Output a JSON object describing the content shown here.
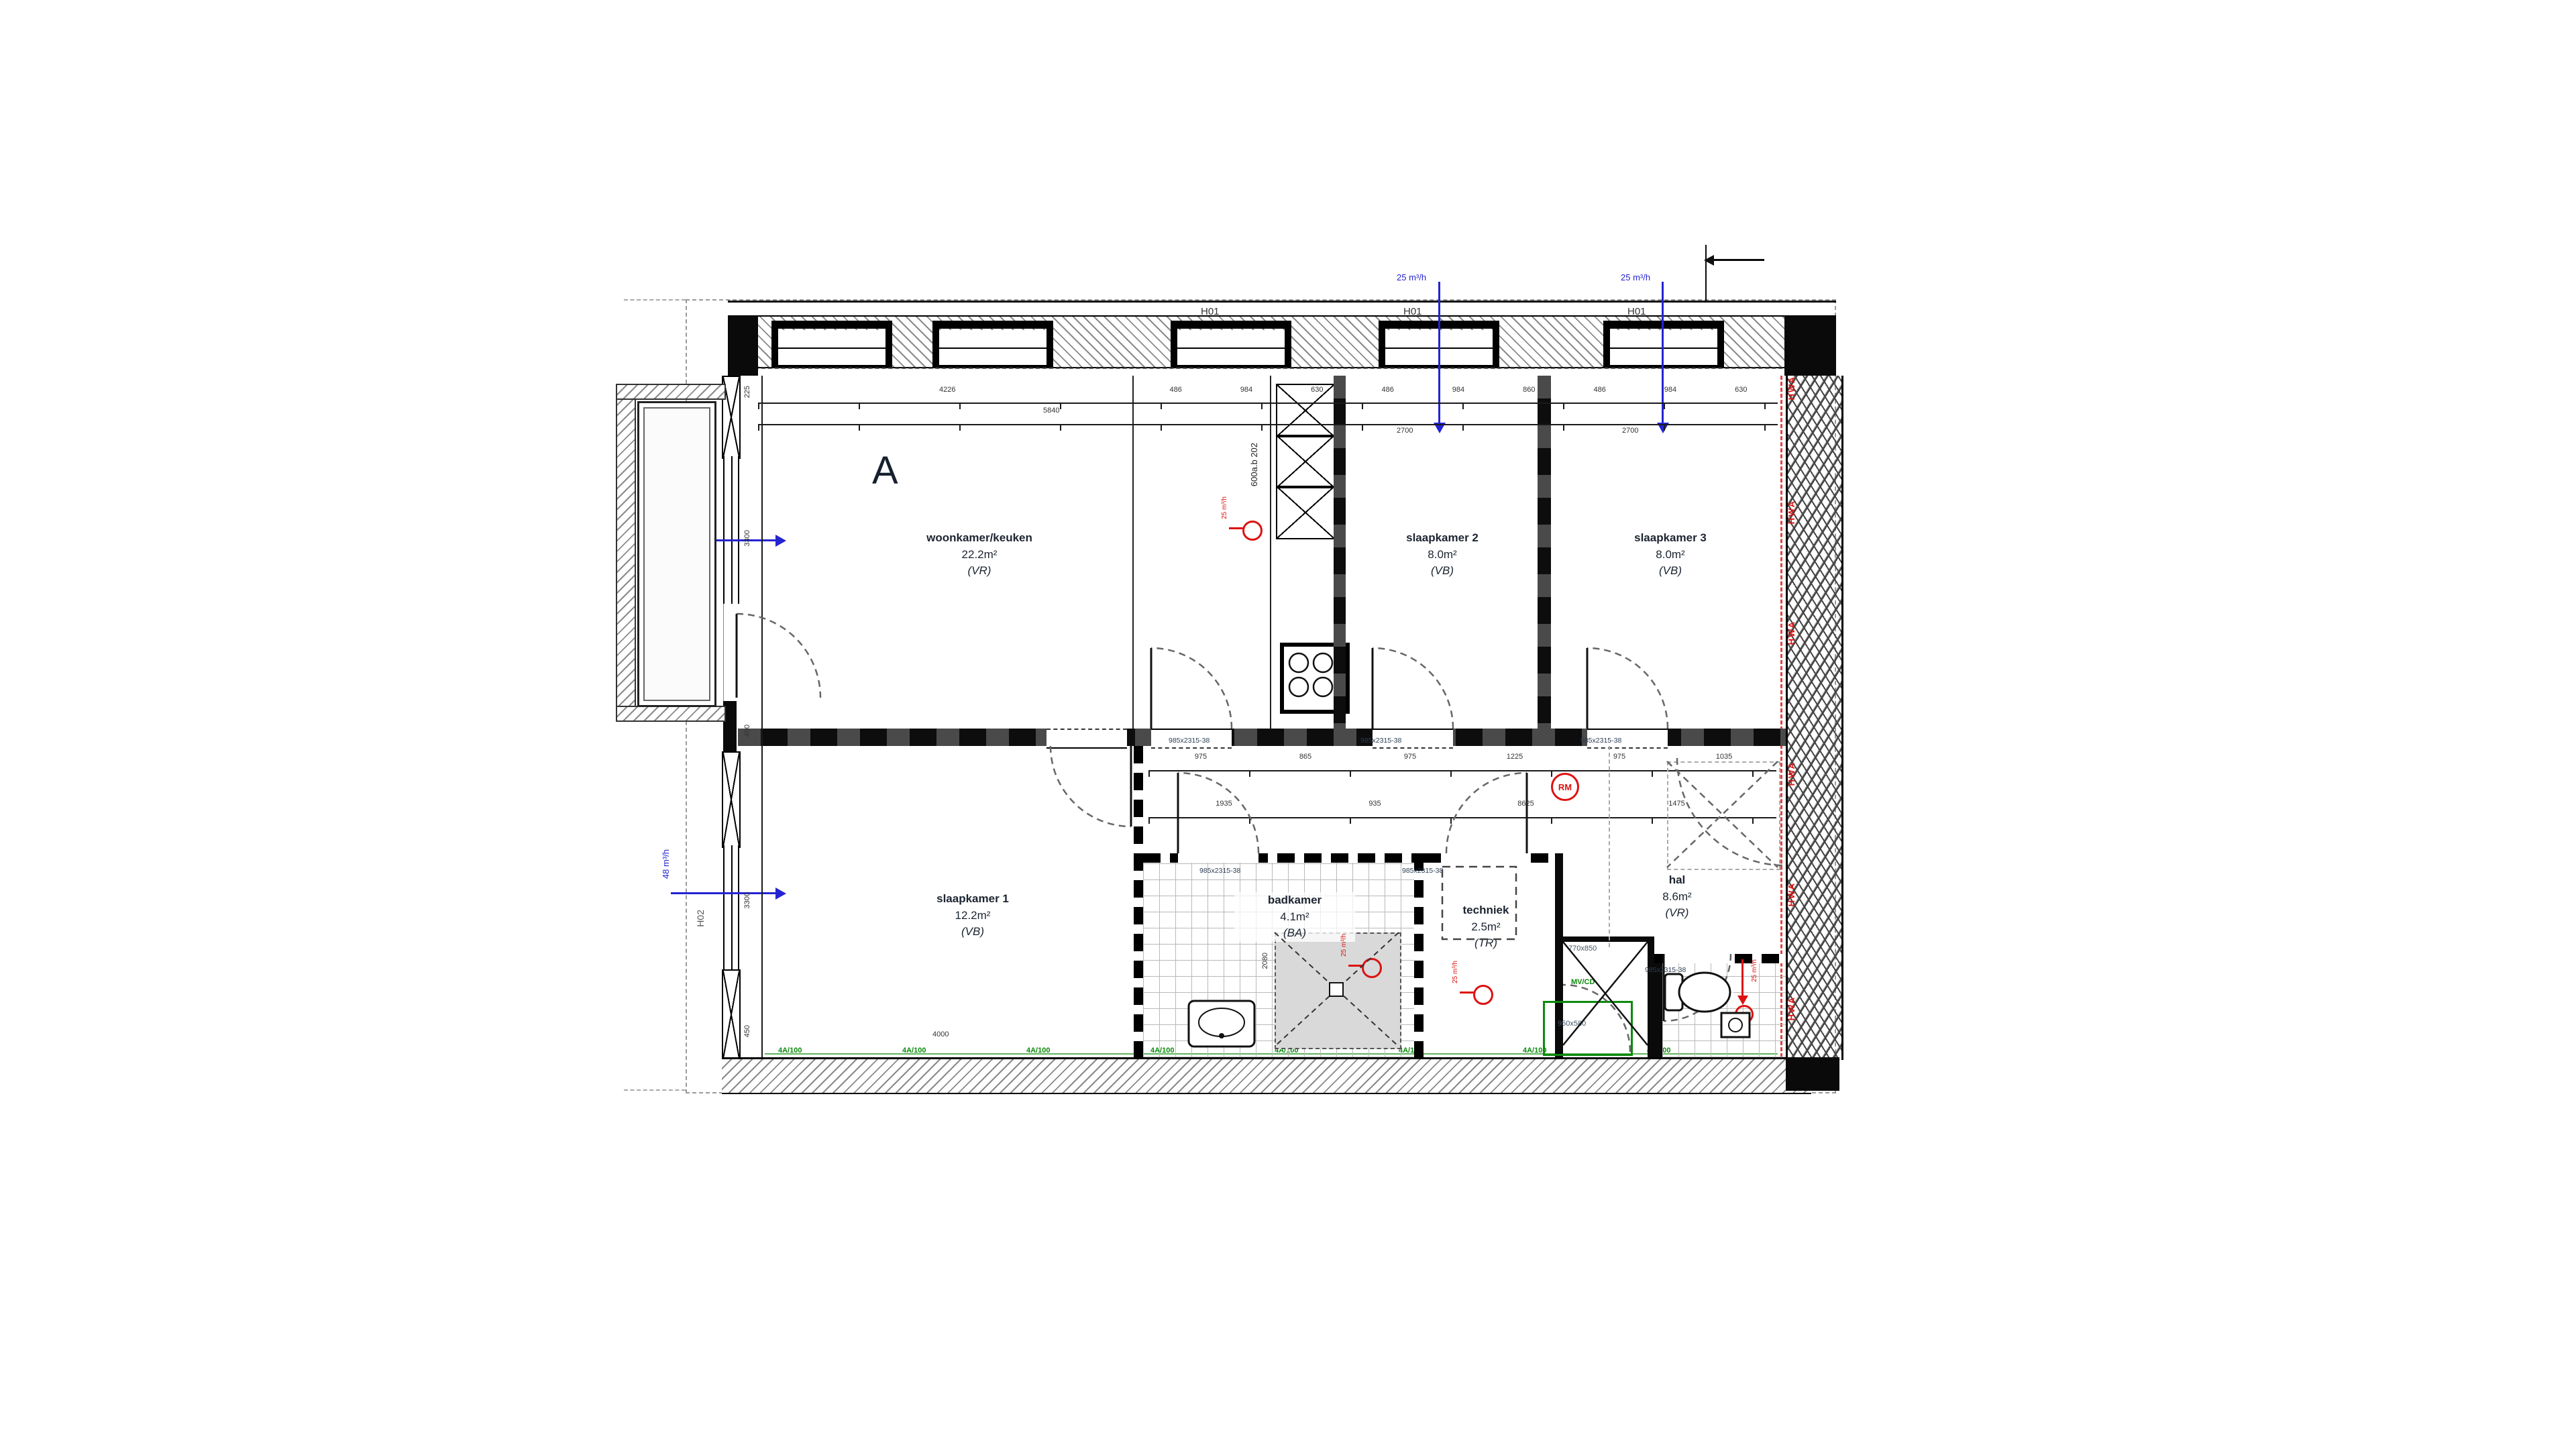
{
  "unit_label": "A",
  "rooms": [
    {
      "name": "woonkamer/keuken",
      "area": "22.2m²",
      "type": "(VR)"
    },
    {
      "name": "slaapkamer 2",
      "area": "8.0m²",
      "type": "(VB)"
    },
    {
      "name": "slaapkamer 3",
      "area": "8.0m²",
      "type": "(VB)"
    },
    {
      "name": "slaapkamer 1",
      "area": "12.2m²",
      "type": "(VB)"
    },
    {
      "name": "badkamer",
      "area": "4.1m²",
      "type": "(BA)"
    },
    {
      "name": "techniek",
      "area": "2.5m²",
      "type": "(TR)"
    },
    {
      "name": "hal",
      "area": "8.6m²",
      "type": "(VR)"
    },
    {
      "name": "toilet",
      "area": "",
      "type": ""
    }
  ],
  "window_labels": {
    "top": [
      "H01",
      "H01",
      "H01"
    ],
    "left_upper": "H10",
    "left_lower": "H02"
  },
  "ventilation": {
    "top_flows": [
      "25 m³/h",
      "25 m³/h"
    ],
    "left_upper_flow": "83 m³/h",
    "left_lower_flow": "48 m³/h",
    "extract_flow": "25 m³/h"
  },
  "markers": {
    "smoke_detector": "RM",
    "riser_label": "HWA",
    "koker_note": "600a.b 202",
    "shaft_size_top": "770x850",
    "shaft_size_bottom": "950x580",
    "meter_label": "MV/CD",
    "door_tag": "985x2315-38",
    "green_mark": "4A/100"
  },
  "dimensions": {
    "top_main": [
      "4226",
      "5840"
    ],
    "top_segments": [
      "486",
      "984",
      "630",
      "486",
      "984",
      "860",
      "486",
      "984",
      "630"
    ],
    "top_totals": [
      "2700",
      "2700"
    ],
    "left_column": [
      "225",
      "3300",
      "450",
      "3300",
      "450"
    ],
    "hall_upper": [
      "975",
      "865",
      "975",
      "1225",
      "975",
      "1035"
    ],
    "hall_lower": [
      "1935",
      "935",
      "8625",
      "1475"
    ],
    "room_bottom": "4000",
    "shower_height": "2080"
  },
  "colors": {
    "line": "#0a0a0a",
    "vent_blue": "#2424d2",
    "alarm_red": "#dd1212",
    "note_green": "#0b8a0b"
  }
}
